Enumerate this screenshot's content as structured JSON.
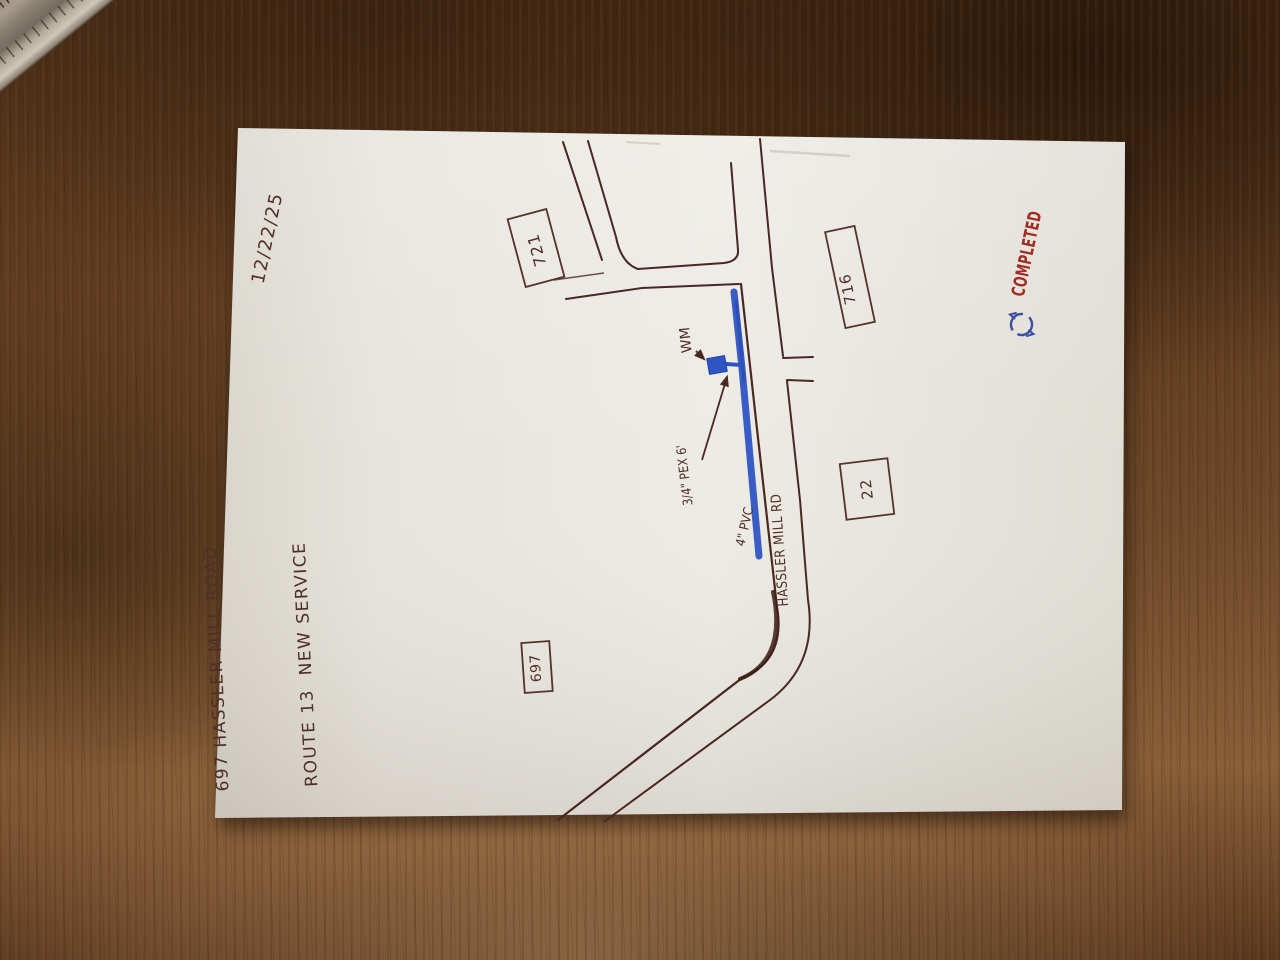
{
  "scene": {
    "kind": "hand-drawn water service sketch on paper, photographed on a wooden desk",
    "date": "12/22/25",
    "title_line1": "697 HASSLER MILL ROAD",
    "title_line2": "ROUTE 13  NEW SERVICE",
    "road_name": "HASSLER MILL RD",
    "stamp": "COMPLETED",
    "parcels": [
      {
        "label": "721"
      },
      {
        "label": "716"
      },
      {
        "label": "22"
      },
      {
        "label": "697"
      }
    ],
    "annotations": {
      "water_meter": "WM",
      "service_line": "3/4\" PEX 6'",
      "main_line": "4\" PVC"
    },
    "icons": {
      "blue_circle_mark": "circle-arrow-scribble",
      "ruler": "ruler-corner"
    },
    "colors": {
      "ink_brown": "#4a2720",
      "marker_blue": "#2f55c3",
      "pen_blue": "#3c4f9e",
      "stamp_red": "#a12c24",
      "paper": "#e9e6df",
      "wood": "#6b4a2e"
    }
  }
}
